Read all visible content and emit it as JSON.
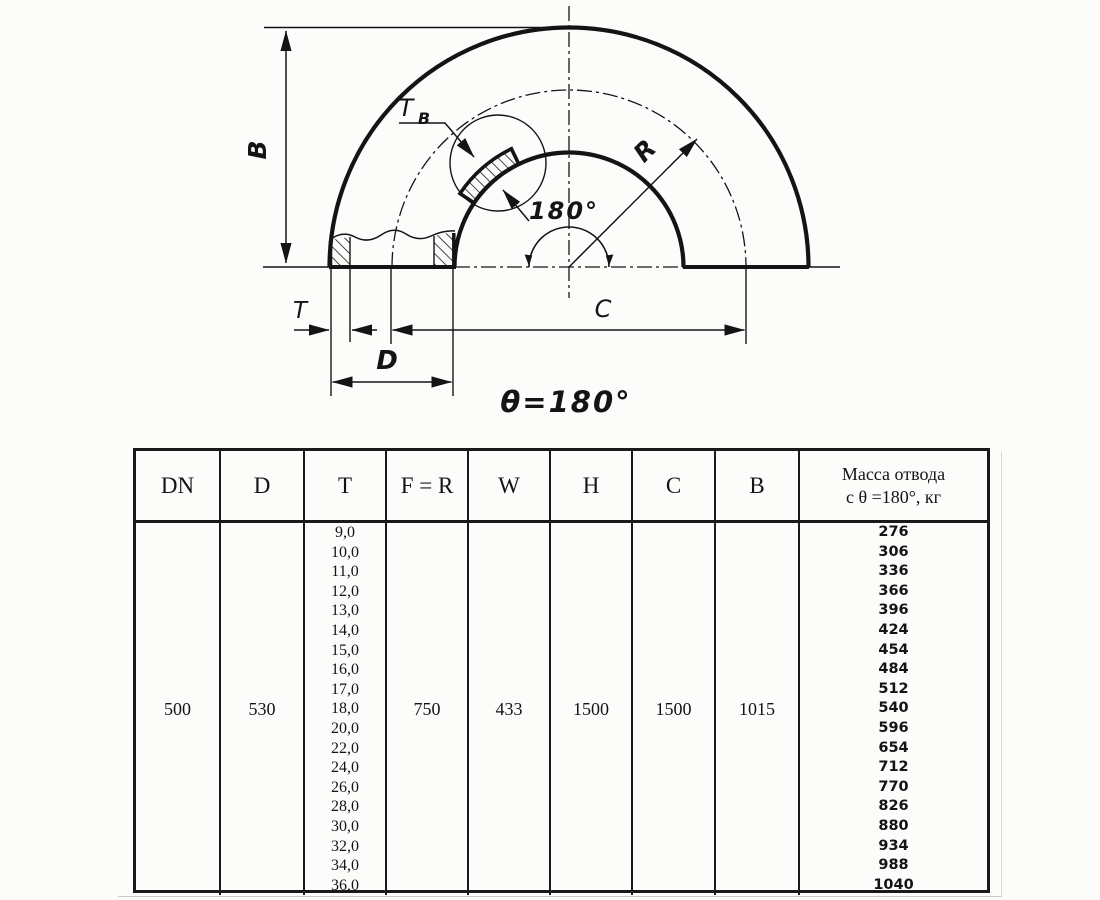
{
  "drawing": {
    "labels": {
      "b_dim": "B",
      "t_wall_main": "T",
      "t_wall_sub": "B",
      "radius": "R",
      "angle": "180°",
      "t_dim": "T",
      "d_dim": "D",
      "c_dim": "C",
      "theta": "θ=180°"
    }
  },
  "table": {
    "headers": [
      "DN",
      "D",
      "T",
      "F = R",
      "W",
      "H",
      "C",
      "B"
    ],
    "mass_header_line1": "Масса отвода",
    "mass_header_line2": "с θ =180°, кг",
    "dn": "500",
    "d": "530",
    "t_values": [
      "9,0",
      "10,0",
      "11,0",
      "12,0",
      "13,0",
      "14,0",
      "15,0",
      "16,0",
      "17,0",
      "18,0",
      "20,0",
      "22,0",
      "24,0",
      "26,0",
      "28,0",
      "30,0",
      "32,0",
      "34,0",
      "36,0"
    ],
    "f_r": "750",
    "w": "433",
    "h": "1500",
    "c": "1500",
    "b": "1015",
    "mass_values": [
      "276",
      "306",
      "336",
      "366",
      "396",
      "424",
      "454",
      "484",
      "512",
      "540",
      "596",
      "654",
      "712",
      "770",
      "826",
      "880",
      "934",
      "988",
      "1040"
    ]
  }
}
